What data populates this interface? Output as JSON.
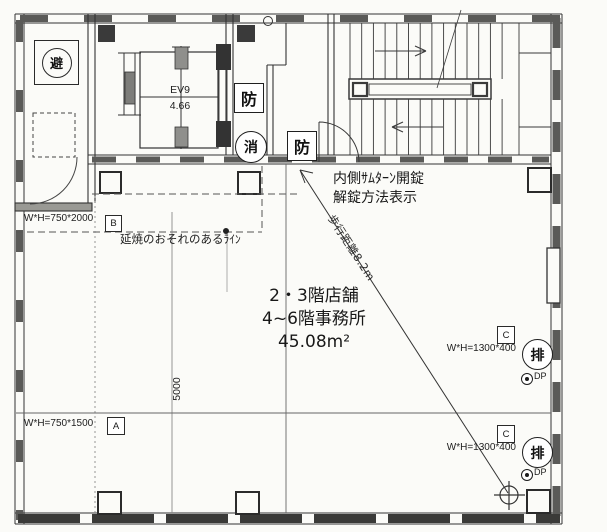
{
  "canvas": {
    "ink": "#2e2e2e",
    "paper": "#fbfbf8"
  },
  "signs": {
    "evacuation": "避",
    "fire_door_upper": "防",
    "fire_door_lower": "防",
    "extinguisher": "消",
    "exhaust_upper": "排",
    "exhaust_lower": "排"
  },
  "elevator": {
    "id": "EV9",
    "area": "4.66"
  },
  "room": {
    "line1": "2・3階店舗",
    "line2": "4~6階事務所",
    "line3": "45.08m²"
  },
  "notes": {
    "unlock_line1": "内側ｻﾑﾀｰﾝ開錠",
    "unlock_line2": "解錠方法表示",
    "fire_spread": "延焼のおそれのあるﾗｲﾝ",
    "walk_distance": "歩行距離8.2m"
  },
  "openings": {
    "b": {
      "label": "W*H=750*2000",
      "tag": "B"
    },
    "a": {
      "label": "W*H=750*1500",
      "tag": "A"
    },
    "c1": {
      "label": "W*H=1300*400",
      "tag": "C",
      "dp": "DP"
    },
    "c2": {
      "label": "W*H=1300*400",
      "tag": "C",
      "dp": "DP"
    }
  },
  "dimensions": {
    "span": "5000"
  }
}
